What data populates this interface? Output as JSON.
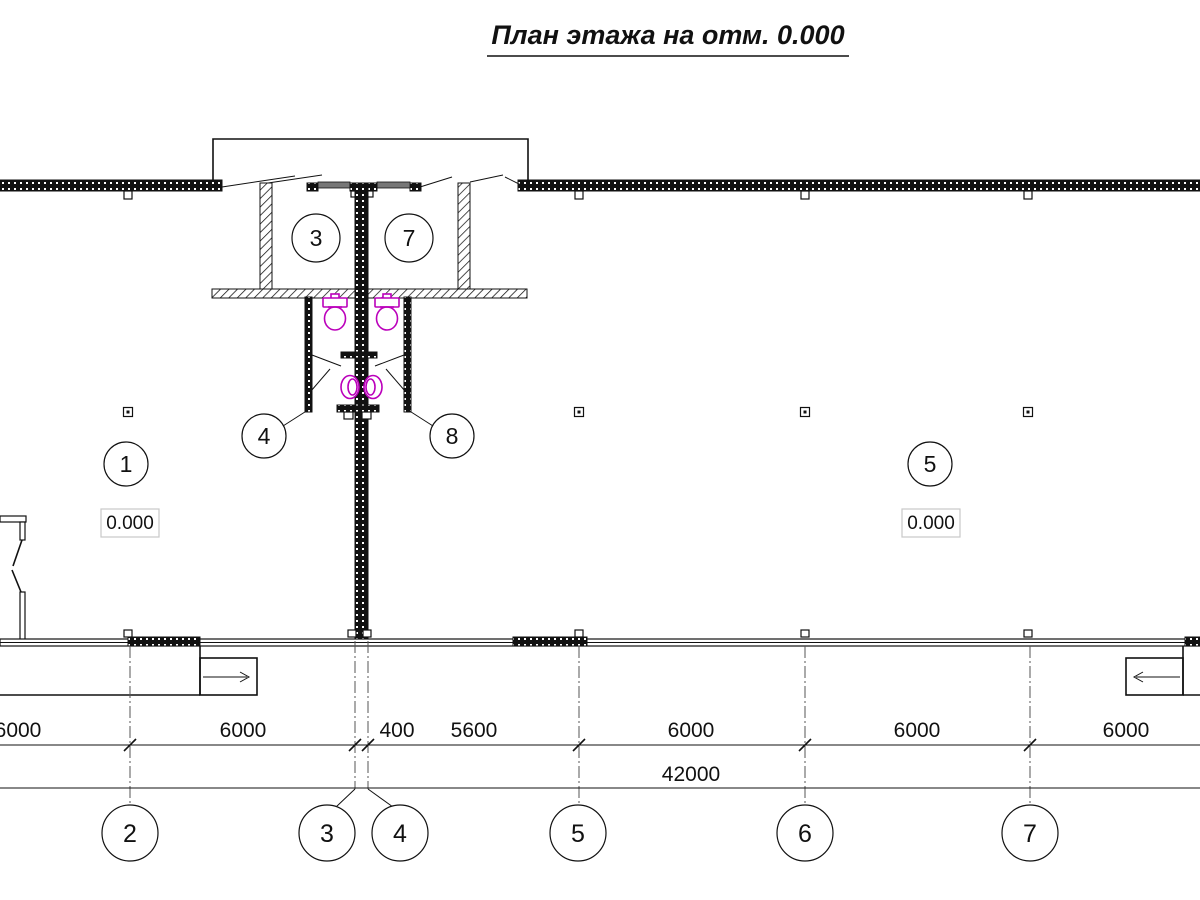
{
  "title": "План этажа на отм. 0.000",
  "plan": {
    "room_tags": {
      "r1": "1",
      "r3": "3",
      "r4": "4",
      "r5": "5",
      "r7": "7",
      "r8": "8"
    },
    "elevations": {
      "left": "0.000",
      "right": "0.000"
    }
  },
  "dimensions": {
    "row1": [
      "6000",
      "6000",
      "400",
      "5600",
      "6000",
      "6000",
      "6000"
    ],
    "total": "42000"
  },
  "axes": {
    "labels": [
      "2",
      "3",
      "4",
      "5",
      "6",
      "7"
    ]
  },
  "colors": {
    "plumbing": "#bb00bb",
    "elevation_box": "#c8c8c8"
  }
}
